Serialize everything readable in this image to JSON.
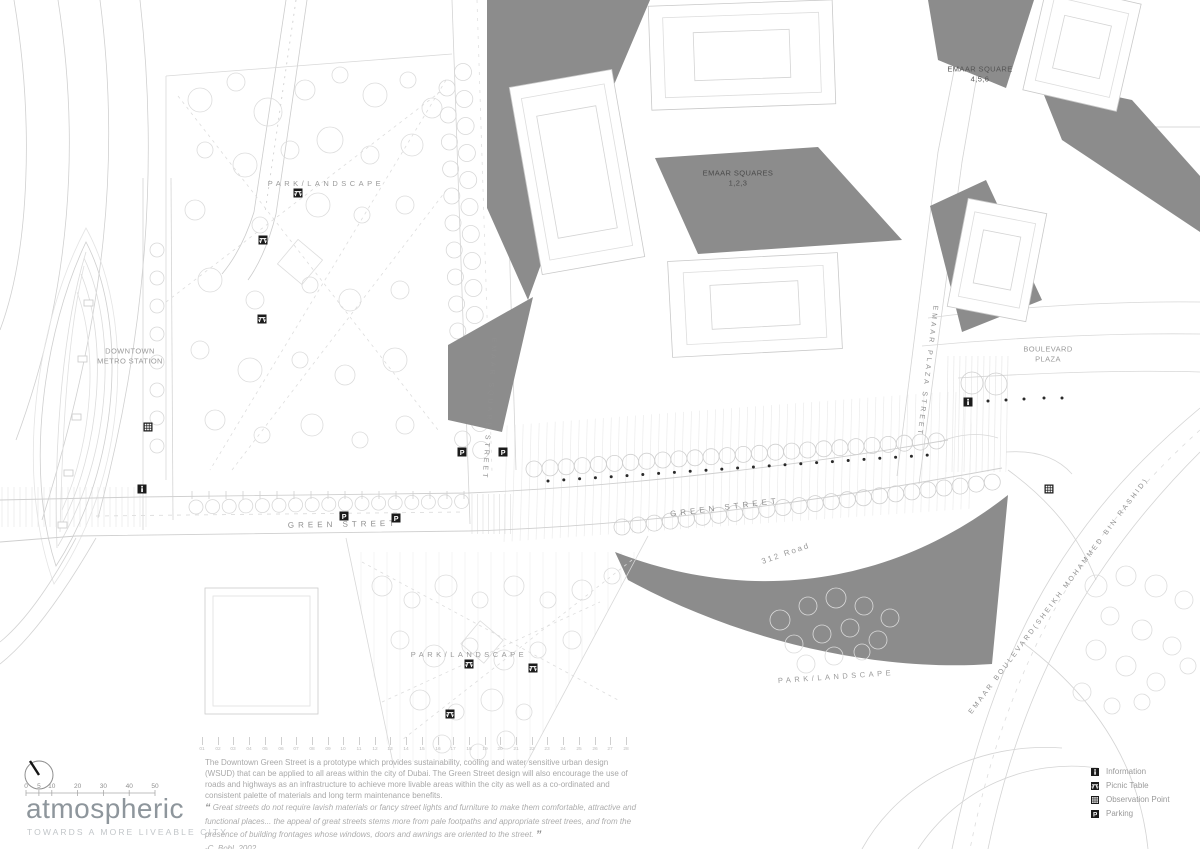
{
  "colors": {
    "background": "#ffffff",
    "linework": "#d4d4d4",
    "linework_light": "#e8e8e8",
    "building_shadow": "#8c8c8c",
    "marker_black": "#1b1b1b",
    "plan_label_gray": "#9a9a9a",
    "plan_label_dark": "#4f4f4f",
    "logo_gray": "#8e969c",
    "tagline_gray": "#c2c6c9",
    "body_text_gray": "#a9a9a9"
  },
  "plan": {
    "labels": [
      {
        "id": "park-landscape-north",
        "lines": [
          "PARK/LANDSCAPE"
        ],
        "x": 326,
        "y": 184,
        "rotate": 0,
        "spacing": 3.5,
        "size": 7.5,
        "color": "#9a9a9a"
      },
      {
        "id": "downtown-metro-station",
        "lines": [
          "DOWNTOWN",
          "METRO STATION"
        ],
        "x": 130,
        "y": 356,
        "rotate": 0,
        "spacing": 0.4,
        "size": 7.5,
        "color": "#9a9a9a"
      },
      {
        "id": "emaar-squares-123",
        "lines": [
          "EMAAR SQUARES",
          "1,2,3"
        ],
        "x": 738,
        "y": 178,
        "rotate": 0,
        "spacing": 0.4,
        "size": 7.5,
        "color": "#4a4a4a"
      },
      {
        "id": "emaar-square-456",
        "lines": [
          "EMAAR SQUARE",
          "4,5,6"
        ],
        "x": 980,
        "y": 74,
        "rotate": 0,
        "spacing": 0.4,
        "size": 7.5,
        "color": "#555555"
      },
      {
        "id": "boulevard-plaza",
        "lines": [
          "BOULEVARD",
          "PLAZA"
        ],
        "x": 1048,
        "y": 354,
        "rotate": 0,
        "spacing": 0.4,
        "size": 7.5,
        "color": "#9a9a9a"
      },
      {
        "id": "emaar-square-street",
        "lines": [
          "EMAAR SQUARE STREET"
        ],
        "x": 489,
        "y": 409,
        "rotate": 94,
        "spacing": 3,
        "size": 7,
        "color": "#8f8f8f"
      },
      {
        "id": "emaar-plaza-street",
        "lines": [
          "EMAAR PLAZA STREET"
        ],
        "x": 927,
        "y": 371,
        "rotate": 97,
        "spacing": 3,
        "size": 7,
        "color": "#8f8f8f"
      },
      {
        "id": "green-street-west",
        "lines": [
          "GREEN STREET"
        ],
        "x": 343,
        "y": 525,
        "rotate": -1,
        "spacing": 4,
        "size": 8,
        "color": "#8f8f8f"
      },
      {
        "id": "green-street-east",
        "lines": [
          "GREEN STREET"
        ],
        "x": 725,
        "y": 508,
        "rotate": -7,
        "spacing": 4,
        "size": 8,
        "color": "#8f8f8f"
      },
      {
        "id": "road-312",
        "lines": [
          "312 Road"
        ],
        "x": 786,
        "y": 554,
        "rotate": -19,
        "spacing": 2,
        "size": 8,
        "color": "#9a9a9a"
      },
      {
        "id": "park-landscape-south",
        "lines": [
          "PARK/LANDSCAPE"
        ],
        "x": 469,
        "y": 655,
        "rotate": 0,
        "spacing": 3.5,
        "size": 7.5,
        "color": "#9a9a9a"
      },
      {
        "id": "park-landscape-east",
        "lines": [
          "PARK/LANDSCAPE"
        ],
        "x": 836,
        "y": 677,
        "rotate": -4,
        "spacing": 3.5,
        "size": 7.5,
        "color": "#9a9a9a"
      },
      {
        "id": "emaar-boulevard",
        "lines": [
          "EMAAR BOULEVARD(SHEIKH MOHAMMED BIN RASHID)"
        ],
        "x": 1059,
        "y": 596,
        "rotate": -53,
        "spacing": 2.5,
        "size": 7,
        "color": "#8f8f8f"
      }
    ],
    "markers": [
      {
        "type": "picnic",
        "x": 298,
        "y": 193
      },
      {
        "type": "picnic",
        "x": 263,
        "y": 240
      },
      {
        "type": "picnic",
        "x": 262,
        "y": 319
      },
      {
        "type": "information",
        "x": 142,
        "y": 489
      },
      {
        "type": "observation",
        "x": 148,
        "y": 427
      },
      {
        "type": "parking",
        "x": 344,
        "y": 516
      },
      {
        "type": "parking",
        "x": 396,
        "y": 518
      },
      {
        "type": "parking",
        "x": 462,
        "y": 452
      },
      {
        "type": "parking",
        "x": 503,
        "y": 452
      },
      {
        "type": "information",
        "x": 968,
        "y": 402
      },
      {
        "type": "observation",
        "x": 1049,
        "y": 489
      },
      {
        "type": "picnic",
        "x": 469,
        "y": 664
      },
      {
        "type": "picnic",
        "x": 533,
        "y": 668
      },
      {
        "type": "picnic",
        "x": 450,
        "y": 714
      }
    ]
  },
  "footer": {
    "logo": {
      "wordmark": "atmospheric",
      "tagline": "TOWARDS A MORE LIVEABLE CITY"
    },
    "scale_bar": {
      "labels": [
        "0",
        "5",
        "10",
        "20",
        "30",
        "40",
        "50"
      ],
      "values": [
        0,
        5,
        10,
        20,
        30,
        40,
        50
      ],
      "max": 50
    },
    "grid_ruler": {
      "numbers": [
        "01",
        "02",
        "03",
        "04",
        "05",
        "06",
        "07",
        "08",
        "09",
        "10",
        "11",
        "12",
        "13",
        "14",
        "15",
        "16",
        "17",
        "18",
        "19",
        "20",
        "21",
        "22",
        "23",
        "24",
        "25",
        "26",
        "27",
        "28"
      ]
    },
    "description": "The Downtown Green Street is a prototype which provides sustainability, cooling and water sensitive urban design (WSUD) that can be applied to all areas within the city of Dubai. The Green Street design will also encourage the use of roads and highways as an infrastructure to achieve more livable areas within the city as well as a co-ordinated and consistent palette of materials and long term maintenance benefits.",
    "quote": {
      "open_mark": "“",
      "close_mark": "”",
      "text": "Great streets do not require lavish materials or fancy street lights and furniture to make them comfortable, attractive and functional places... the appeal of great streets stems more from pale footpaths and appropriate street trees, and from the presence of building frontages whose windows, doors and awnings are oriented to the street.",
      "attribution": "-C. Bohl, 2002"
    },
    "legend": {
      "items": [
        {
          "icon": "information-icon",
          "label": "Information"
        },
        {
          "icon": "picnic-table-icon",
          "label": "Picnic Table"
        },
        {
          "icon": "observation-point-icon",
          "label": "Observation Point"
        },
        {
          "icon": "parking-icon",
          "label": "Parking"
        }
      ]
    }
  }
}
